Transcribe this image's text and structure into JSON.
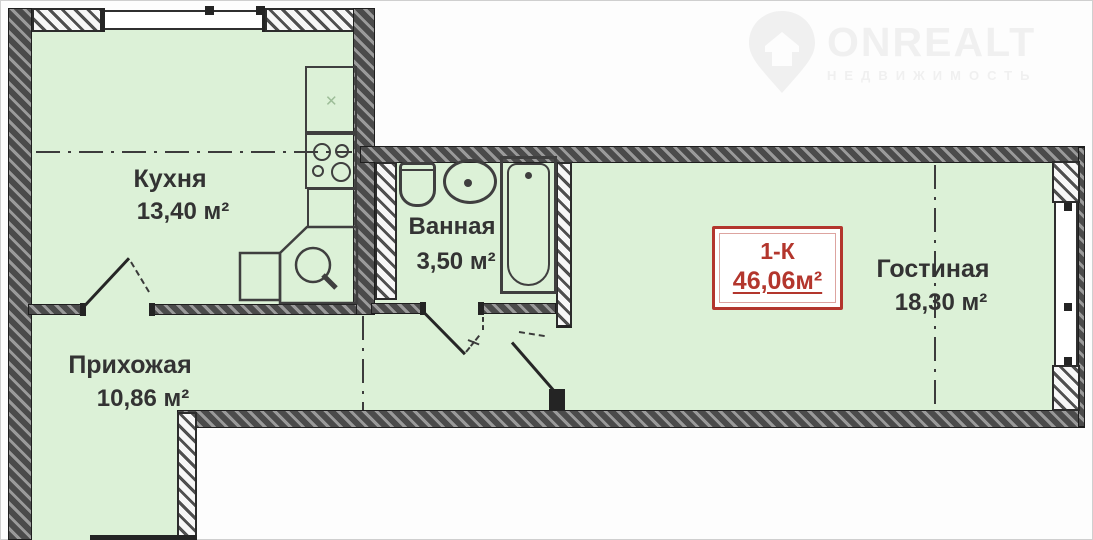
{
  "logo": {
    "brand": "ONREALT",
    "tagline": "НЕДВИЖИМОСТЬ"
  },
  "summary": {
    "type_label": "1-К",
    "total_area": "46,06м²"
  },
  "rooms": [
    {
      "id": "kitchen",
      "name": "Кухня",
      "area": "13,40 м²"
    },
    {
      "id": "bathroom",
      "name": "Ванная",
      "area": "3,50 м²"
    },
    {
      "id": "living",
      "name": "Гостиная",
      "area": "18,30 м²"
    },
    {
      "id": "hallway",
      "name": "Прихожая",
      "area": "10,86 м²"
    }
  ],
  "fixtures": [
    "kitchen-counter",
    "cooktop-stove",
    "kitchen-corner-sink",
    "toilet",
    "wash-basin",
    "bathtub"
  ],
  "colors": {
    "room_fill": "#dcf1d7",
    "wall_dark": "#4b4b4b",
    "accent_red": "#b3362d",
    "line": "#3f3f3f",
    "watermark": "#f0f0f0"
  }
}
